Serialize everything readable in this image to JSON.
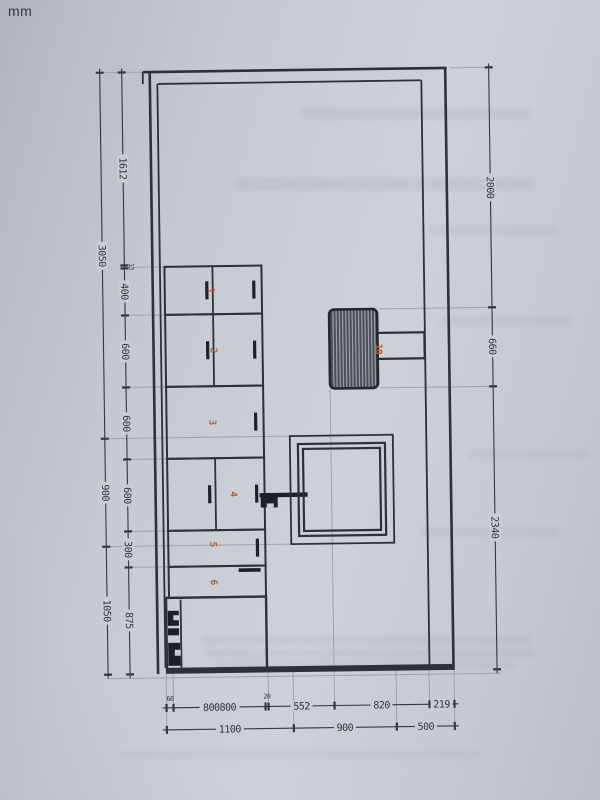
{
  "unit_label": "mm",
  "dimensions": {
    "left_outer": [
      "3050",
      "900",
      "1050"
    ],
    "left_inner": [
      "1612",
      "13",
      "400",
      "600",
      "600",
      "600",
      "300",
      "875"
    ],
    "right": [
      "2000",
      "660",
      "2340"
    ],
    "bottom_upper": [
      "60",
      "800800",
      "20",
      "552",
      "820",
      "219"
    ],
    "bottom_lower": [
      "1100",
      "900",
      "500"
    ]
  },
  "item_labels": [
    "1",
    "2",
    "3",
    "4",
    "5",
    "6",
    "10"
  ],
  "colors": {
    "paper": "#c9cdd5",
    "line": "#2e3138",
    "construction": "#959ba6",
    "accent_orange": "#b35f36"
  }
}
